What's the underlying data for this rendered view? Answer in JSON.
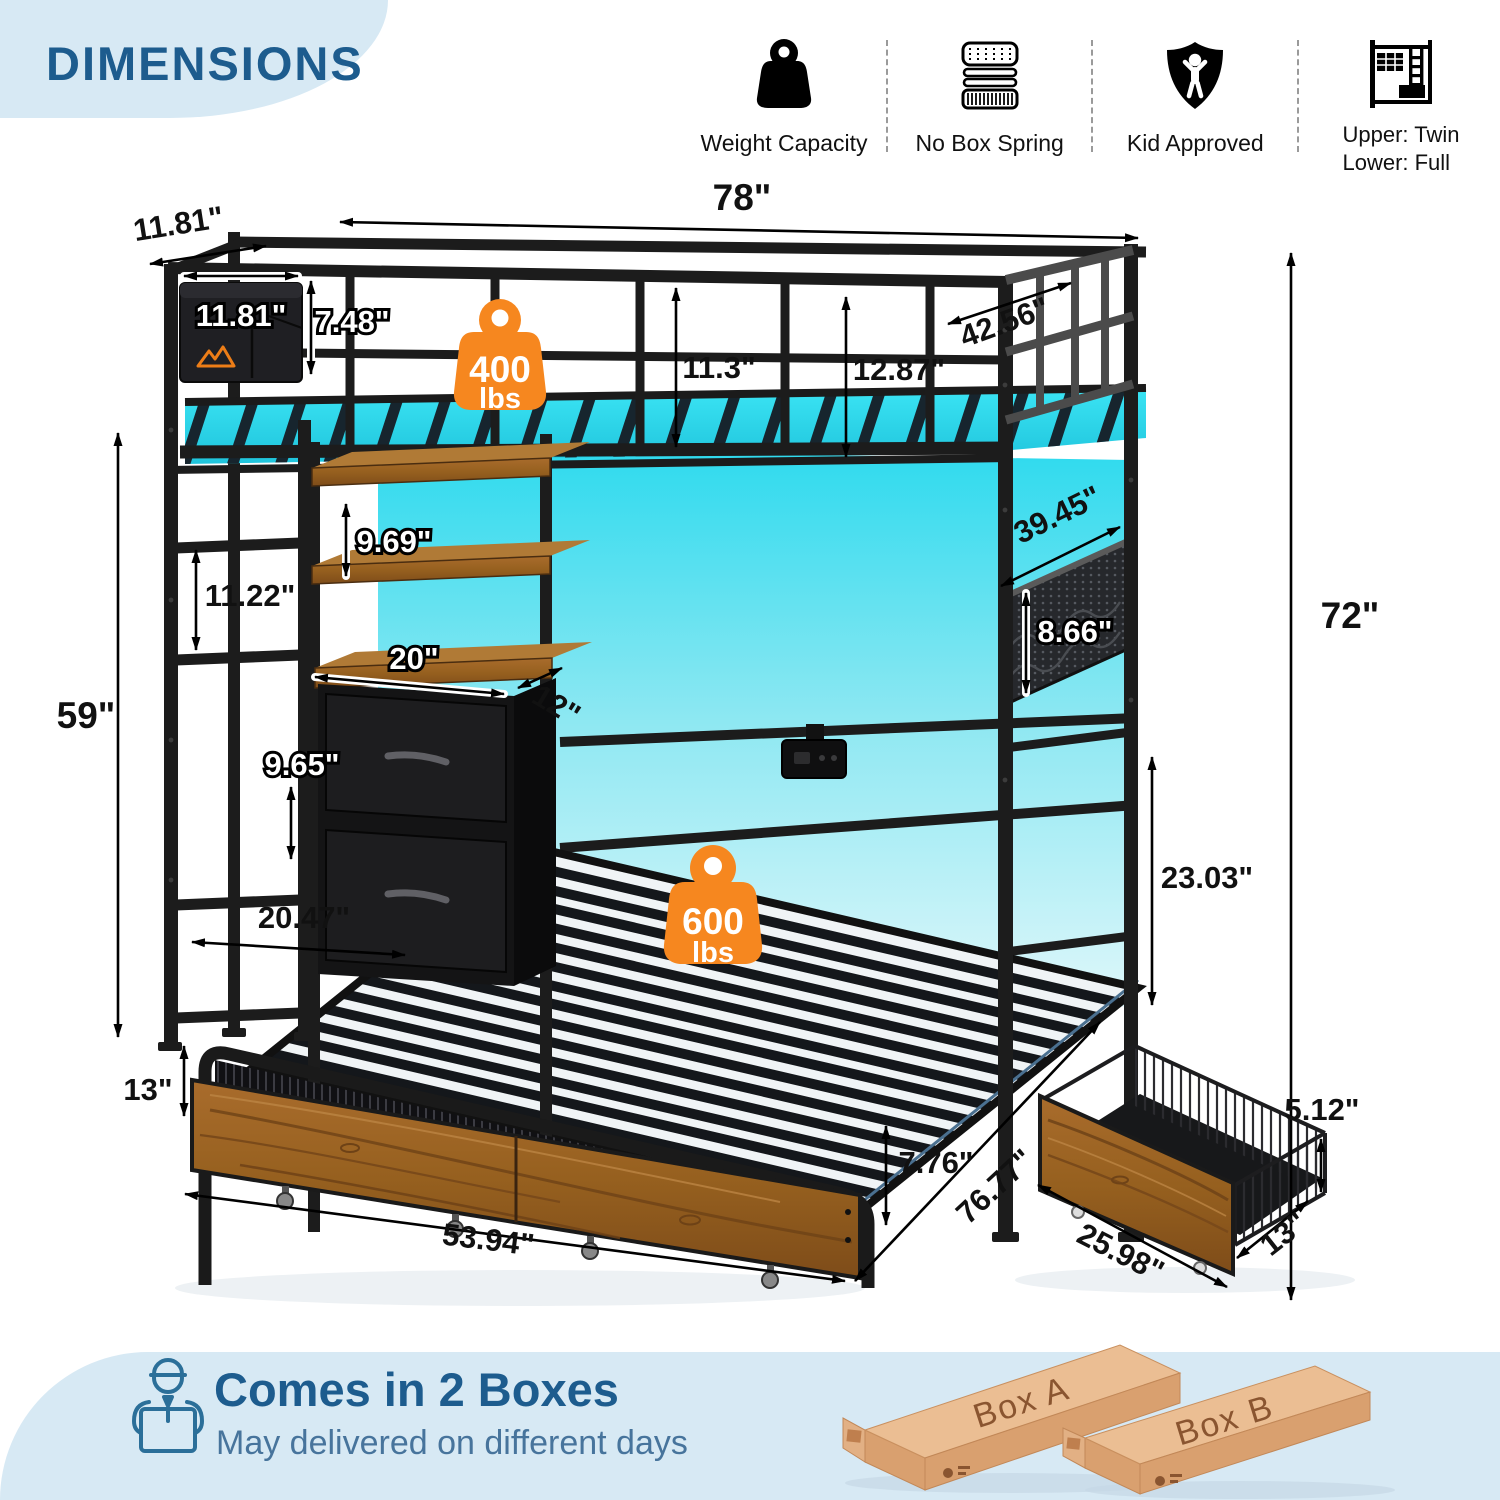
{
  "header": {
    "title": "DIMENSIONS",
    "features": [
      {
        "icon": "weight-capacity-icon",
        "label": "Weight Capacity"
      },
      {
        "icon": "no-box-spring-icon",
        "label": "No Box Spring"
      },
      {
        "icon": "kid-approved-icon",
        "label": "Kid Approved"
      },
      {
        "icon": "bunk-size-icon",
        "label": "Upper:  Twin",
        "label2": "Lower:  Full"
      }
    ]
  },
  "diagram": {
    "badges": {
      "upper": {
        "value": "400",
        "unit": "lbs"
      },
      "lower": {
        "value": "600",
        "unit": "lbs"
      }
    },
    "dimensions": {
      "top_length": "78\"",
      "end_depth": "11.81\"",
      "pocket_width": "11.81\"",
      "pocket_height": "7.48\"",
      "guardrail_height_mid": "11.3\"",
      "guardrail_height_right": "12.87\"",
      "upper_bed_width": "42.56\"",
      "net_panel_length": "39.45\"",
      "net_panel_height": "8.66\"",
      "overall_height": "72\"",
      "shelf_spacing": "9.69\"",
      "ladder_rung_spacing": "11.22\"",
      "under_loft_height": "59\"",
      "drawer_unit_width": "20\"",
      "drawer_unit_depth": "12\"",
      "drawer_unit_height": "9.65\"",
      "side_clearance_depth": "20.47\"",
      "underbed_clearance": "13\"",
      "lower_bed_width": "53.94\"",
      "lower_frame_height": "7.76\"",
      "lower_bed_length": "76.77\"",
      "under_bunk_clearance": "23.03\"",
      "storage_drawer_length": "25.98\"",
      "storage_drawer_width": "13\"",
      "storage_drawer_height": "5.12\""
    }
  },
  "footer": {
    "title": "Comes in 2 Boxes",
    "subtitle": "May delivered on different days",
    "boxes": [
      {
        "label": "Box A"
      },
      {
        "label": "Box B"
      }
    ]
  },
  "colors": {
    "accent_blue": "#1d5c8e",
    "banner_blue": "#d7e9f4",
    "badge_orange": "#f6871f",
    "led_cyan": "#2edaee",
    "wood_brown": "#9a6126"
  }
}
